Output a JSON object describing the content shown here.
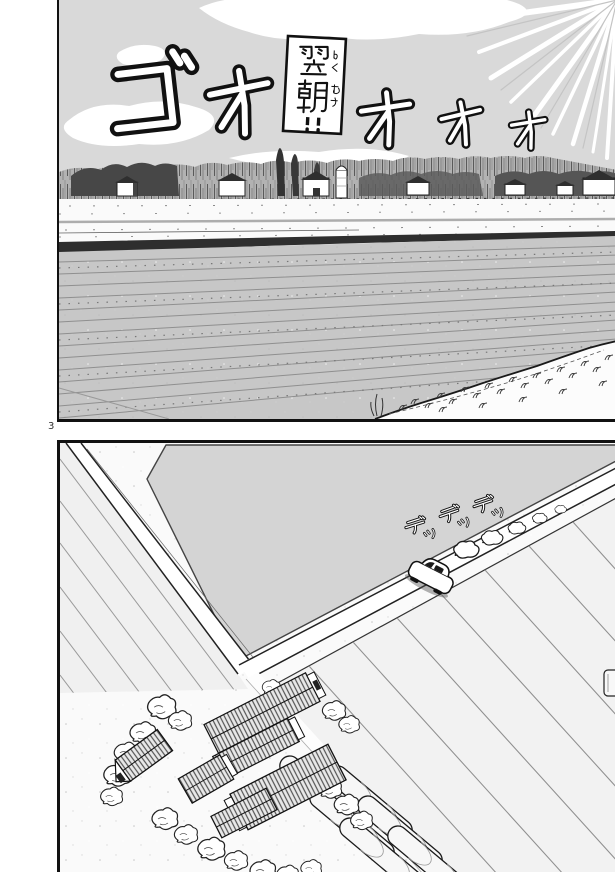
{
  "page": {
    "number": "3"
  },
  "panel_top": {
    "caption": {
      "text": "翌朝!!",
      "furigana": "よくあさ"
    },
    "sfx_wind": {
      "text": "ゴオオオオ",
      "characters": [
        "ゴ",
        "オ",
        "オ",
        "オ",
        "オ"
      ]
    },
    "colors": {
      "sky": "#d9d9d9",
      "clouds": "#ffffff",
      "field": "#c7c7c7",
      "bank": "#2e2e2e",
      "ink": "#1a1a1a"
    }
  },
  "panel_bottom": {
    "sfx_engine": {
      "text": "デッデッデッ",
      "characters": [
        "デ",
        "ッ",
        "デ",
        "ッ",
        "デ",
        "ッ"
      ]
    },
    "colors": {
      "ground": "#fafafa",
      "pond": "#d4d4d4",
      "fields": "#f1f1f1",
      "roads": "#ffffff"
    }
  }
}
